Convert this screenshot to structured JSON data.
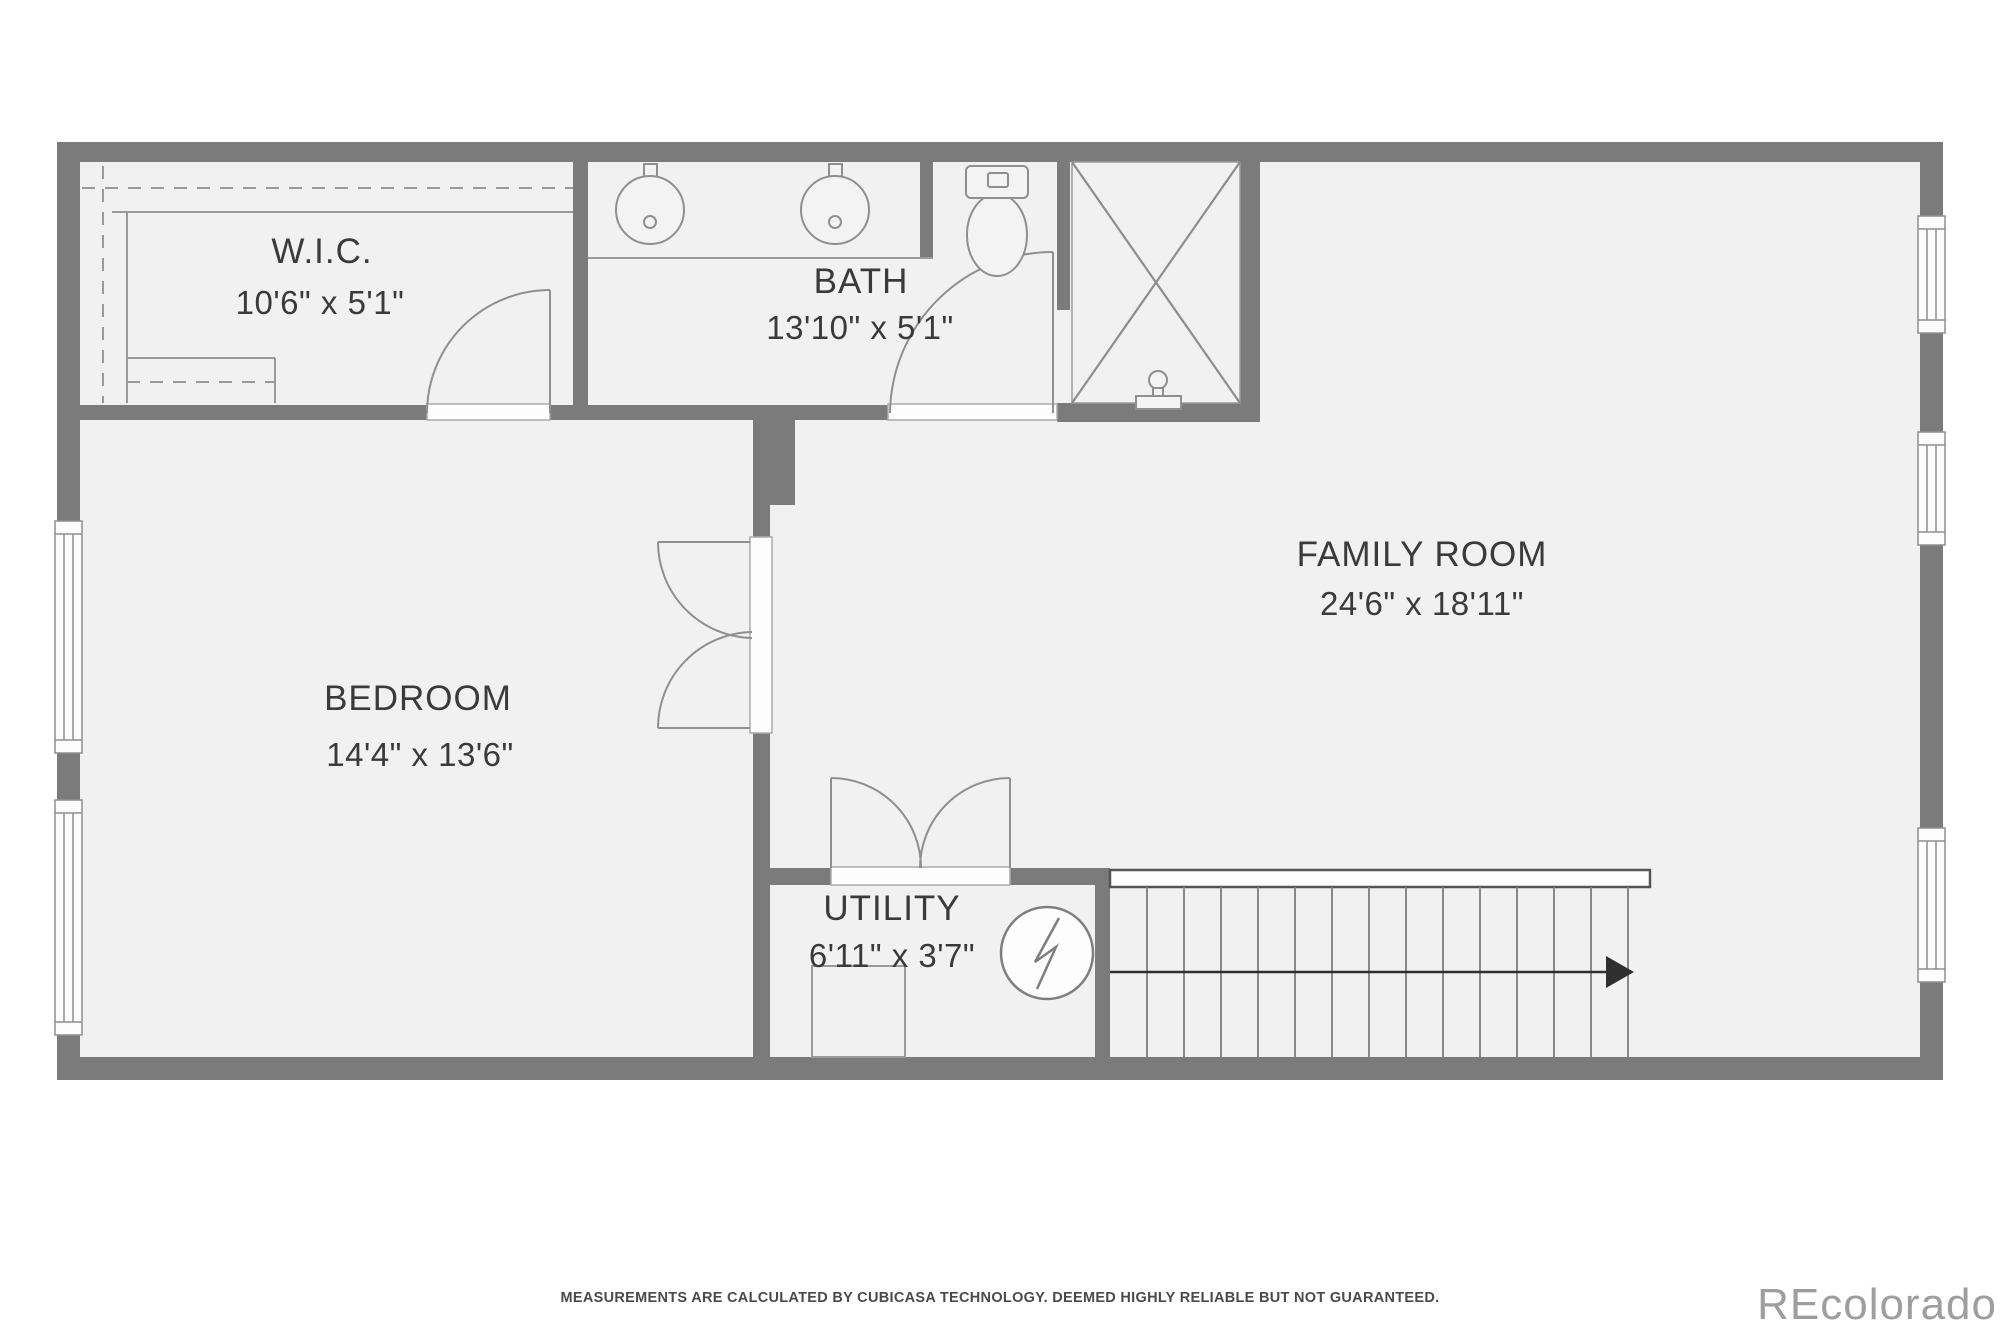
{
  "plan": {
    "type": "floor-plan",
    "rooms": [
      {
        "id": "wic",
        "name": "W.I.C.",
        "dims": "10'6\" x 5'1\""
      },
      {
        "id": "bath",
        "name": "BATH",
        "dims": "13'10\" x 5'1\""
      },
      {
        "id": "family_room",
        "name": "FAMILY ROOM",
        "dims": "24'6\" x 18'11\""
      },
      {
        "id": "bedroom",
        "name": "BEDROOM",
        "dims": "14'4\" x 13'6\""
      },
      {
        "id": "utility",
        "name": "UTILITY",
        "dims": "6'11\" x 3'7\""
      }
    ],
    "fixtures": [
      "double-sink-vanity",
      "toilet",
      "shower",
      "furnace",
      "water-heater",
      "stairs-up-arrow",
      "windows",
      "door-swings",
      "closet-shelving"
    ],
    "colors": {
      "wall": "#7b7b7b",
      "floor": "#f1f1f1",
      "fixture_outline": "#8f8f8f",
      "label_text": "#3a3a3a",
      "disclaimer_text": "#4a4a4a",
      "watermark_text": "#9e9e9e"
    }
  },
  "footer": {
    "disclaimer": "MEASUREMENTS ARE CALCULATED BY CUBICASA TECHNOLOGY. DEEMED HIGHLY RELIABLE BUT NOT GUARANTEED."
  },
  "watermark": {
    "text": "REcolorado"
  }
}
